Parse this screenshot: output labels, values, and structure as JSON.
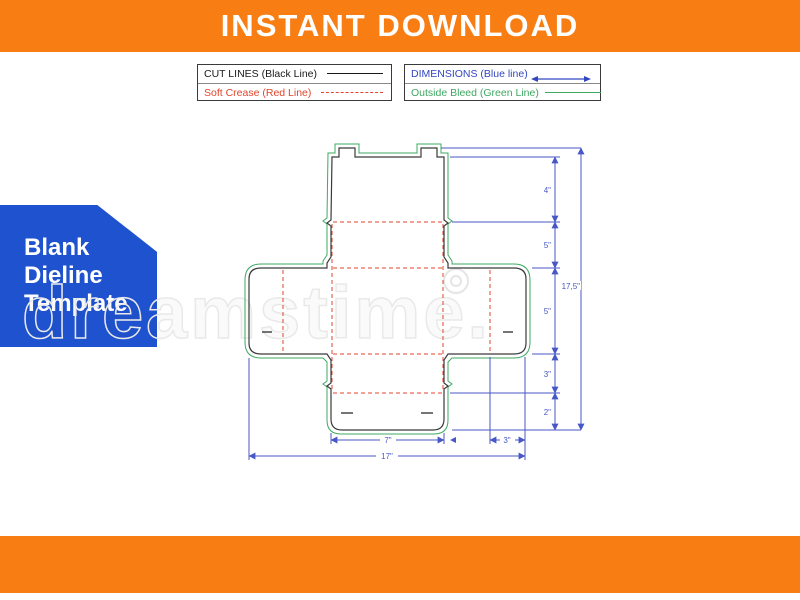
{
  "header": {
    "title": "INSTANT DOWNLOAD"
  },
  "legend": {
    "cut_label": "CUT LINES (Black Line)",
    "crease_label": "Soft Crease (Red Line)",
    "dimensions_label": "DIMENSIONS (Blue line)",
    "bleed_label": "Outside Bleed (Green Line)"
  },
  "badge": {
    "lines": [
      "Blank",
      "Dieline",
      "Template"
    ]
  },
  "watermark": {
    "text": "dreamstime."
  },
  "dieline": {
    "dims": {
      "right_segments": [
        "4\"",
        "5\"",
        "5\"",
        "3\"",
        "2\""
      ],
      "right_total": "17,5\"",
      "bottom_flap_width": "7\"",
      "bottom_side_width": "3\"",
      "bottom_total": "17\""
    }
  },
  "colors": {
    "accent_orange": "#F87E14",
    "badge_blue": "#1F52CF",
    "dimension_blue": "#4757C5",
    "crease_red": "#E2442A",
    "bleed_green": "#3FA863",
    "cut_black": "#3A3A3A"
  }
}
